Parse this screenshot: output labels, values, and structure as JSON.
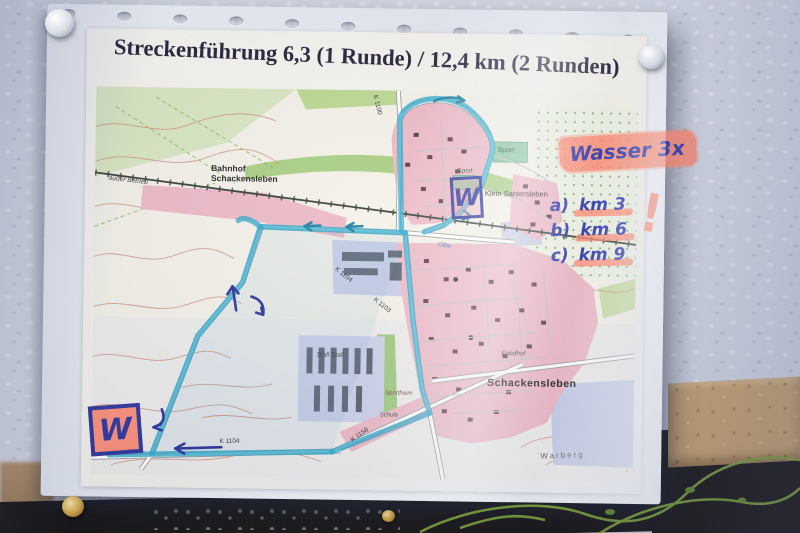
{
  "scene": {
    "description": "Photo of a printed race-route map in a plastic sleeve pinned to a woodchip wall",
    "wall_color": "#d6dae6",
    "board_color": "#c9a36d",
    "vine_color": "#7aa035"
  },
  "paper": {
    "title": "Streckenführung 6,3 (1 Runde) / 12,4 km (2 Runden)",
    "title_color": "#1b1b33"
  },
  "annotations": {
    "wasser_note": "Wasser 3x",
    "km_list": [
      {
        "prefix": "a)",
        "value": "km 3"
      },
      {
        "prefix": "b)",
        "value": "km 6"
      },
      {
        "prefix": "c)",
        "value": "km 9"
      }
    ],
    "water_marker_top": "W",
    "water_marker_bottom": "W",
    "exclamation_mark": "!",
    "highlighter_color": "#ff846a",
    "marker_color": "#27309b",
    "route_color": "#2ba7c9"
  },
  "map_labels": [
    {
      "text": "Bahnhof Schackensleben",
      "x": 116,
      "y": 76,
      "size": 8.5,
      "color": "#1d1d1d",
      "bold": true,
      "width": 78
    },
    {
      "text": "außer Betrieb",
      "x": 14,
      "y": 88,
      "size": 6.5,
      "color": "#3a3a3a",
      "italic": true,
      "rotate": 6
    },
    {
      "text": "Klein Santersleben",
      "x": 390,
      "y": 98,
      "size": 7.5,
      "color": "#222222"
    },
    {
      "text": "Sport",
      "x": 402,
      "y": 55,
      "size": 7,
      "color": "#1f4d38"
    },
    {
      "text": "Sport",
      "x": 362,
      "y": 76,
      "size": 6.5,
      "color": "#1f4d38"
    },
    {
      "text": "Schackensleben",
      "x": 395,
      "y": 286,
      "size": 10.5,
      "color": "#1c1c1c",
      "bold": true,
      "spacing": 0.5
    },
    {
      "text": "Friedhof",
      "x": 409,
      "y": 258,
      "size": 6.5,
      "color": "#444444",
      "italic": true
    },
    {
      "text": "Warberg",
      "x": 449,
      "y": 360,
      "size": 8,
      "color": "#68645c",
      "spacing": 2,
      "rotate": -3
    },
    {
      "text": "Stall Stall",
      "x": 224,
      "y": 262,
      "size": 6.5,
      "color": "#3f3f3f",
      "italic": true
    },
    {
      "text": "Sportheim",
      "x": 293,
      "y": 300,
      "size": 6,
      "color": "#7a4040",
      "italic": true
    },
    {
      "text": "Schule",
      "x": 288,
      "y": 322,
      "size": 6,
      "color": "#3f3f3f",
      "italic": true
    },
    {
      "text": "Olbe",
      "x": 344,
      "y": 150,
      "size": 6.5,
      "color": "#3a7ab5",
      "italic": true,
      "rotate": 8
    },
    {
      "text": "K 1104",
      "x": 244,
      "y": 176,
      "size": 6.5,
      "color": "#333333",
      "rotate": 38
    },
    {
      "text": "K 1103",
      "x": 283,
      "y": 206,
      "size": 6.5,
      "color": "#333333",
      "rotate": 38
    },
    {
      "text": "K 1100",
      "x": 282,
      "y": 4,
      "size": 6.5,
      "color": "#333333",
      "rotate": 75
    },
    {
      "text": "K 1104",
      "x": 128,
      "y": 350,
      "size": 6.5,
      "color": "#333333",
      "rotate": -2
    },
    {
      "text": "K 1158",
      "x": 258,
      "y": 348,
      "size": 6.5,
      "color": "#333333",
      "rotate": -36
    }
  ]
}
